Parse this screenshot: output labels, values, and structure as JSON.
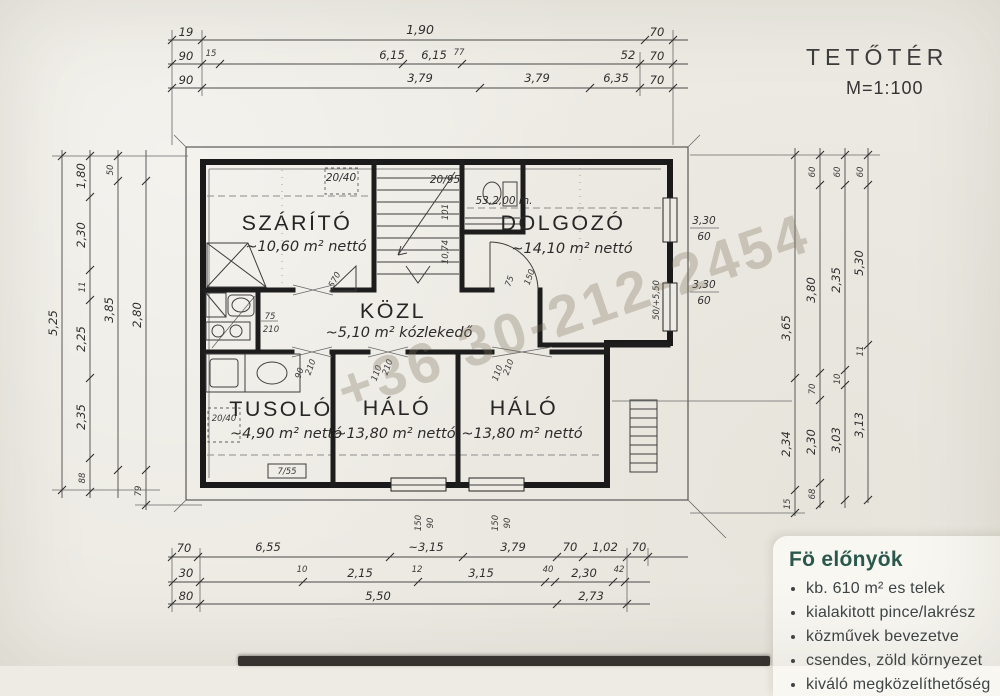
{
  "title": {
    "main": "TETŐTÉR",
    "scale": "M=1:100"
  },
  "watermark": "+36 30-212-2454",
  "rooms": [
    {
      "name": "SZÁRÍTÓ",
      "area": "~10,60 m² nettó"
    },
    {
      "name": "DOLGOZÓ",
      "area": "~14,10 m² nettó"
    },
    {
      "name": "KÖZL",
      "area": "~5,10 m² kózlekedő"
    },
    {
      "name": "TUSOLÓ",
      "area": "~4,90 m² nettó"
    },
    {
      "name": "HÁLÓ",
      "area": "~13,80 m² nettó"
    },
    {
      "name": "HÁLÓ",
      "area": "~13,80 m² nettó"
    }
  ],
  "dims": {
    "top1": [
      "19",
      "1,90",
      "70"
    ],
    "top2": [
      "90",
      "15",
      "6,15",
      "6,15",
      "77",
      "52",
      "70"
    ],
    "top3": [
      "90",
      "3,79",
      "3,79",
      "6,35",
      "70"
    ],
    "bottom1": [
      "70",
      "6,55",
      "~3,15",
      "3,79",
      "70",
      "1,02",
      "70"
    ],
    "bottom2": [
      "30",
      "10",
      "2,15",
      "12",
      "3,15",
      "40",
      "2,30",
      "42"
    ],
    "bottom3": [
      "80",
      "5,50",
      "2,73"
    ],
    "left_a": [
      "5,25"
    ],
    "left_b": [
      "1,80",
      "2,30",
      "11",
      "2,25",
      "2,35",
      "88"
    ],
    "left_c": [
      "50",
      "3,85"
    ],
    "left_d": [
      "2,80",
      "79"
    ],
    "right_a": [
      "3,65",
      "2,34",
      "15"
    ],
    "right_b": [
      "60",
      "3,80",
      "70",
      "2,30",
      "68"
    ],
    "right_c": [
      "60",
      "2,35",
      "10",
      "3,03"
    ],
    "right_d": [
      "60",
      "5,30",
      "11",
      "3,13"
    ]
  },
  "annotations": {
    "skylight1": "20/40",
    "wc_window": "20/95",
    "level": "53,2,00 m.",
    "win_r1_a": "3,30",
    "win_r1_b": "60",
    "win_r2_a": "3,30",
    "win_r2_b": "60",
    "right_wall_note": "50/+5,50",
    "roof_note": "570",
    "bath_door_a": "75",
    "bath_door_b": "210",
    "stair_a": "101",
    "stair_b": "10,74",
    "skylight2": "20/40",
    "tusolo_box": "7/55",
    "door_dolgozo_a": "75",
    "door_dolgozo_b": "150",
    "door1_a": "90",
    "door1_b": "210",
    "door2_a": "110",
    "door2_b": "210",
    "door3_a": "110",
    "door3_b": "210",
    "win_b1_a": "150",
    "win_b1_b": "90",
    "win_b2_a": "150",
    "win_b2_b": "90"
  },
  "infobox": {
    "heading": "Fö előnyök",
    "items": [
      "kb. 610 m² es telek",
      "kialakitott pince/lakrész",
      "közművek bevezetve",
      "csendes, zöld környezet",
      "kiváló megközelíthetőség"
    ]
  }
}
